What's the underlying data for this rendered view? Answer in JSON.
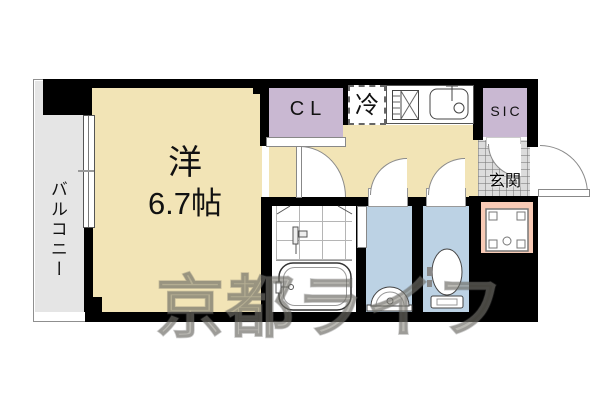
{
  "floorplan": {
    "labels": {
      "balcony": "バルコニー",
      "main_room": "洋",
      "main_room_size": "6.7帖",
      "closet": "CL",
      "fridge": "冷",
      "shoe_closet": "SIC",
      "entrance": "玄関"
    },
    "watermark": "京都ライフ",
    "colors": {
      "floor": "#f2e4b6",
      "closet": "#c9b8d2",
      "water": "#bcd2e4",
      "laundry": "#f8cab5",
      "balcony": "#e5e5e5",
      "tile": "#dcdcdc",
      "wall": "#000000"
    },
    "icons": {
      "stove-icon": "gas stove grid with cross",
      "kitchen-sink-icon": "rounded sink with faucet",
      "bathtub-icon": "rounded bathtub outline",
      "shower-mixer-icon": "bath faucet fixture",
      "washbasin-icon": "half-round wash basin",
      "toilet-icon": "toilet bowl with tank",
      "washer-pan-icon": "washing machine pan with drain",
      "window-icon": "sliding window to balcony",
      "door-swing-icon": "quarter-circle door swing"
    }
  }
}
